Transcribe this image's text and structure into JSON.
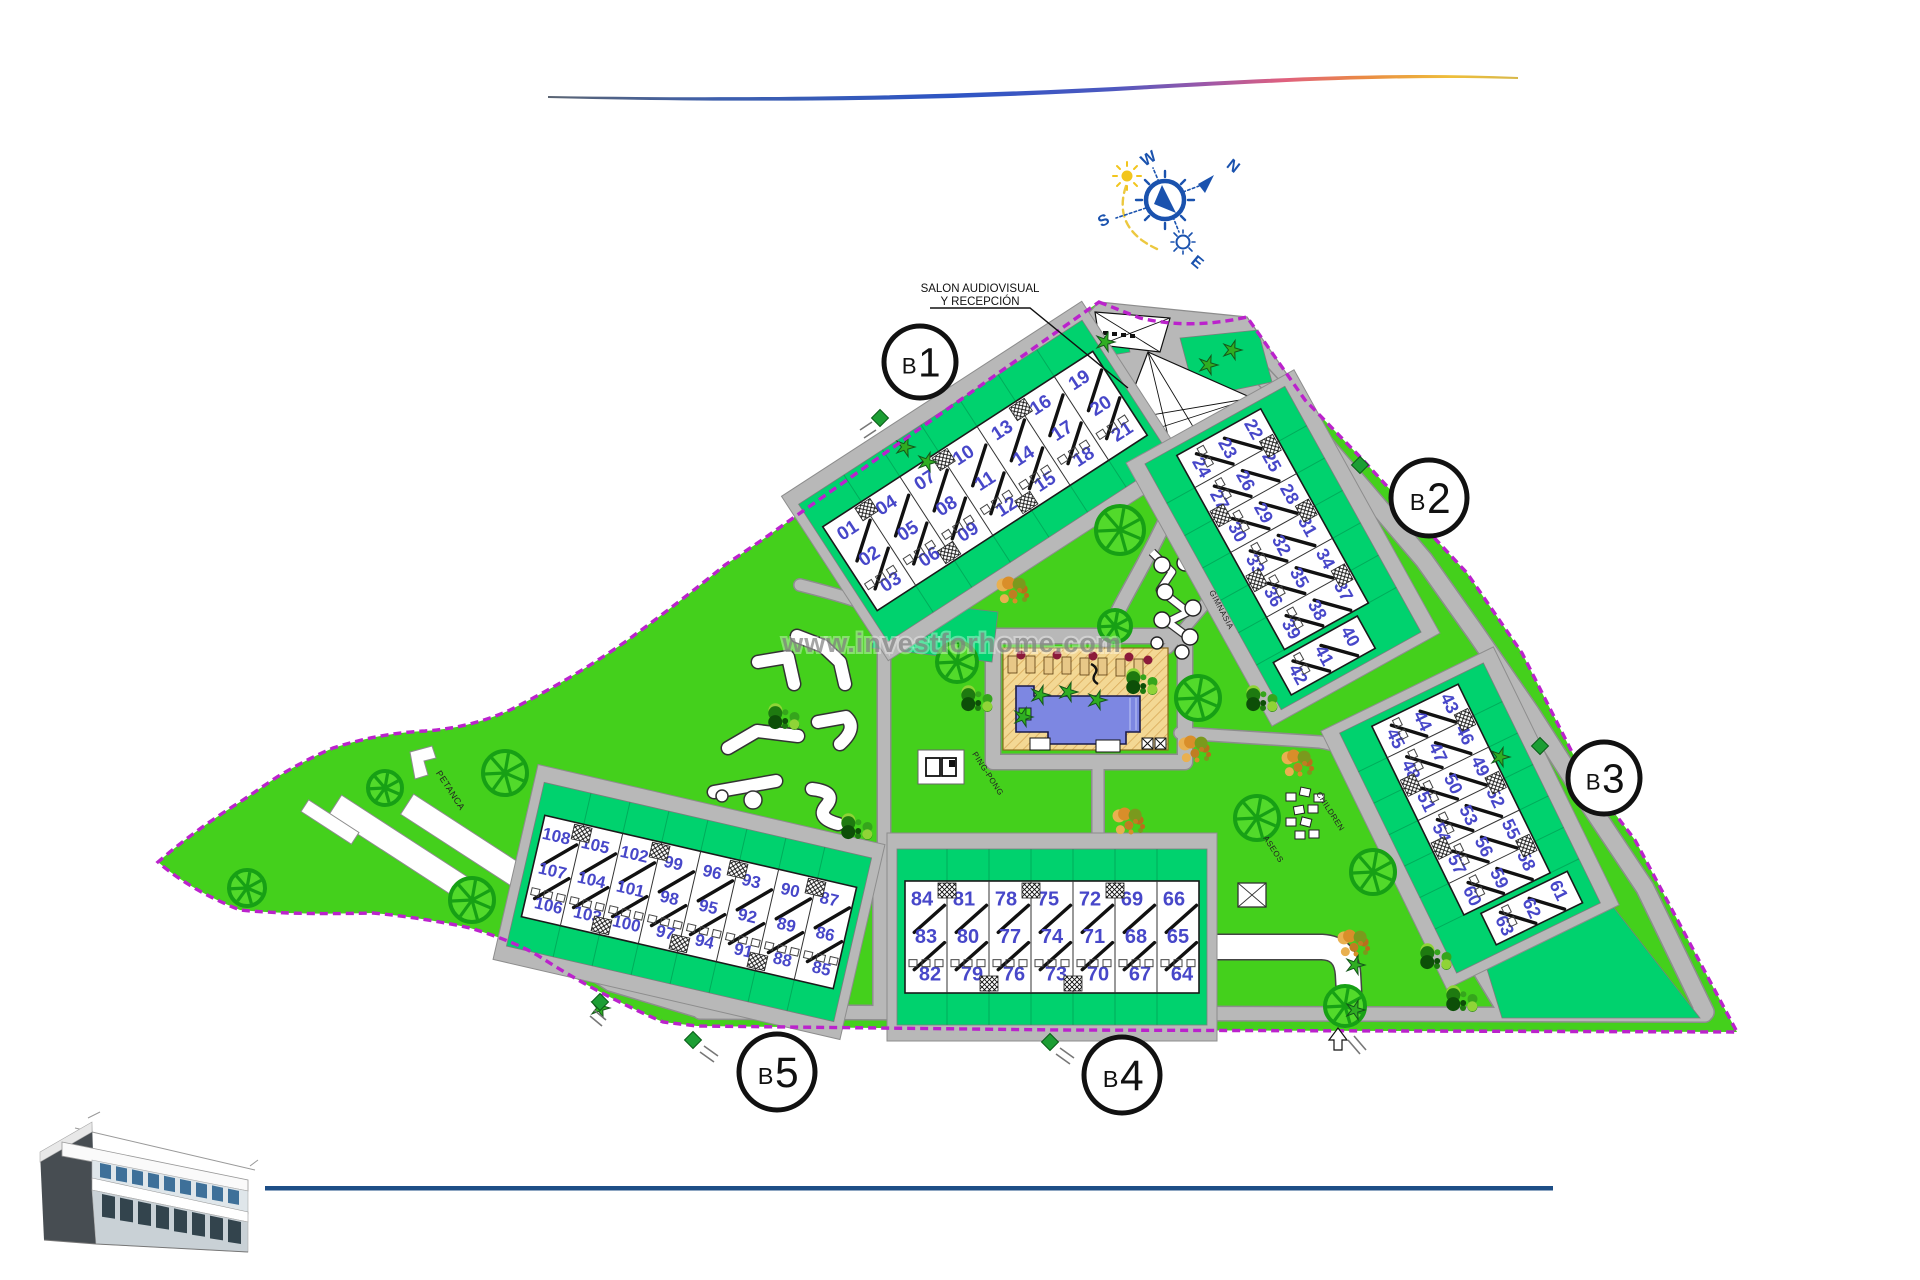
{
  "page": {
    "watermark": "www.investforhome.com"
  },
  "compass": {
    "west": "W",
    "north": "N",
    "south": "S",
    "east": "E"
  },
  "annotations": {
    "reception_line1": "SALON AUDIOVISUAL",
    "reception_line2": "Y RECEPCIÓN",
    "petanca": "PETANCA",
    "ping_pong": "PING-PONG",
    "gimnasia": "GIMNASIA",
    "children": "CHILDREN",
    "aseos": "ASEOS"
  },
  "colors": {
    "lawn": "#44d01c",
    "garden_plot": "#00d26e",
    "path_gray": "#b8b8b8",
    "boundary_purple": "#bb22cc",
    "unit_number_blue": "#4747c9",
    "pool_water": "#7d87e2",
    "pool_deck": "#f3d894",
    "tree_green": "#17a015",
    "compass_blue": "#1a52ae",
    "footer_navy": "#1d4e86"
  },
  "buildings": [
    {
      "id": "b1",
      "label": "B1",
      "columns": [
        [
          "01",
          "02",
          "03"
        ],
        [
          "04",
          "05",
          "06"
        ],
        [
          "07",
          "08",
          "09"
        ],
        [
          "10",
          "11",
          "12"
        ],
        [
          "13",
          "14",
          "15"
        ],
        [
          "16",
          "17",
          "18"
        ],
        [
          "19",
          "20",
          "21"
        ]
      ]
    },
    {
      "id": "b2",
      "label": "B2",
      "columns": [
        [
          "22",
          "23",
          "24"
        ],
        [
          "25",
          "26",
          "27"
        ],
        [
          "28",
          "29",
          "30"
        ],
        [
          "31",
          "32",
          "33"
        ],
        [
          "34",
          "35",
          "36"
        ],
        [
          "37",
          "38",
          "39"
        ],
        [
          "40",
          "41",
          "42"
        ]
      ]
    },
    {
      "id": "b3",
      "label": "B3",
      "columns": [
        [
          "43",
          "44",
          "45"
        ],
        [
          "46",
          "47",
          "48"
        ],
        [
          "49",
          "50",
          "51"
        ],
        [
          "52",
          "53",
          "54"
        ],
        [
          "55",
          "56",
          "57"
        ],
        [
          "58",
          "59",
          "60"
        ],
        [
          "61",
          "62",
          "63"
        ]
      ]
    },
    {
      "id": "b4",
      "label": "B4",
      "columns": [
        [
          "84",
          "83",
          "82"
        ],
        [
          "81",
          "80",
          "79"
        ],
        [
          "78",
          "77",
          "76"
        ],
        [
          "75",
          "74",
          "73"
        ],
        [
          "72",
          "71",
          "70"
        ],
        [
          "69",
          "68",
          "67"
        ],
        [
          "66",
          "65",
          "64"
        ]
      ]
    },
    {
      "id": "b5",
      "label": "B5",
      "columns": [
        [
          "108",
          "107",
          "106"
        ],
        [
          "105",
          "104",
          "103"
        ],
        [
          "102",
          "101",
          "100"
        ],
        [
          "99",
          "98",
          "97"
        ],
        [
          "96",
          "95",
          "94"
        ],
        [
          "93",
          "92",
          "91"
        ],
        [
          "90",
          "89",
          "88"
        ],
        [
          "87",
          "86",
          "85"
        ]
      ]
    }
  ]
}
